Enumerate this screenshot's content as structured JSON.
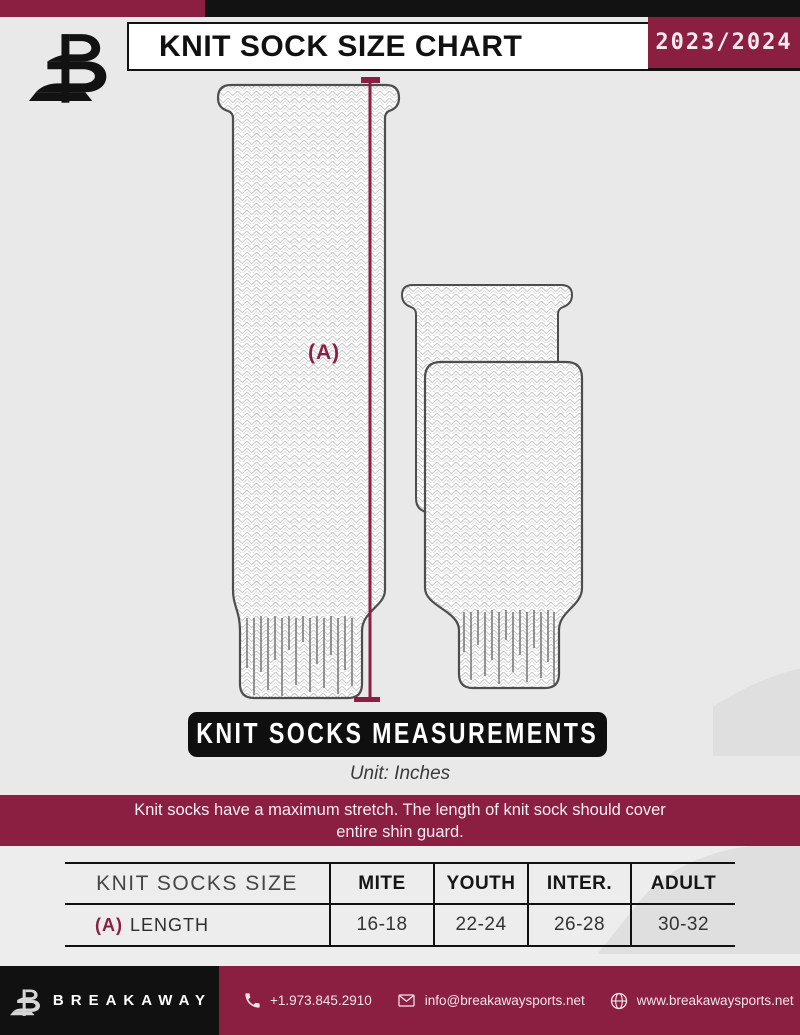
{
  "header": {
    "title": "KNIT SOCK SIZE CHART",
    "season": "2023/2024"
  },
  "diagram": {
    "measure_label": "(A)"
  },
  "measurements": {
    "banner_title": "KNIT SOCKS MEASUREMENTS",
    "unit": "Unit: Inches"
  },
  "note": {
    "line1": "Knit socks have a maximum stretch. The length of knit sock should cover",
    "line2": "entire shin guard."
  },
  "table": {
    "header": [
      "KNIT SOCKS SIZE",
      "MITE",
      "YOUTH",
      "INTER.",
      "ADULT"
    ],
    "row": {
      "prefix": "(A)",
      "label": "LENGTH",
      "values": [
        "16-18",
        "22-24",
        "26-28",
        "30-32"
      ]
    }
  },
  "chart_data": {
    "type": "table",
    "title": "KNIT SOCKS MEASUREMENTS",
    "unit": "Inches",
    "columns": [
      "KNIT SOCKS SIZE",
      "MITE",
      "YOUTH",
      "INTER.",
      "ADULT"
    ],
    "rows": [
      [
        "(A) LENGTH",
        "16-18",
        "22-24",
        "26-28",
        "30-32"
      ]
    ]
  },
  "footer": {
    "brand": "BREAKAWAY",
    "phone": "+1.973.845.2910",
    "email": "info@breakawaysports.net",
    "website": "www.breakawaysports.net"
  },
  "icons": {
    "logo": "breakaway-b-logo",
    "watermark": "breakaway-b-watermark",
    "phone": "phone-icon",
    "mail": "mail-icon",
    "globe": "globe-icon"
  },
  "colors": {
    "maroon": "#8b1f42",
    "ink": "#121212",
    "page_bg": "#e9e9e9"
  }
}
